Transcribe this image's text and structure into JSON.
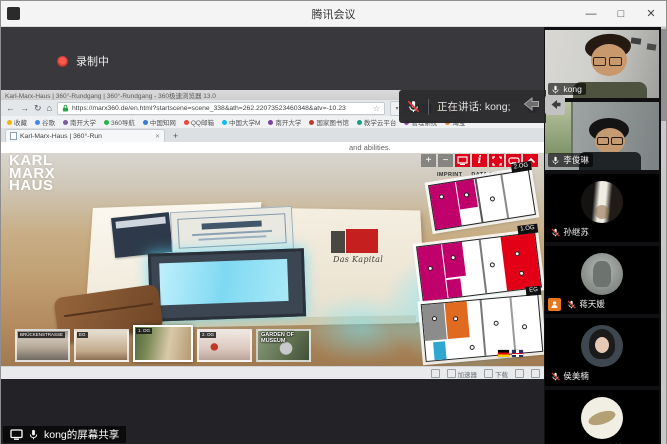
{
  "window": {
    "title": "腾讯会议",
    "minimize": "—",
    "maximize": "□",
    "close": "✕"
  },
  "meeting": {
    "recording_label": "录制中",
    "speaking_label": "正在讲话: kong;",
    "share_label": "kong的屏幕共享"
  },
  "participants": [
    {
      "name": "kong",
      "muted": false,
      "speaking": true
    },
    {
      "name": "李俊琳",
      "muted": false,
      "speaking": false
    },
    {
      "name": "孙继苏",
      "muted": true,
      "speaking": false
    },
    {
      "name": "蒋天媛",
      "muted": true,
      "speaking": false,
      "role_badge": true
    },
    {
      "name": "侯美楠",
      "muted": true,
      "speaking": false
    },
    {
      "name": "191820054张楠",
      "muted": true,
      "speaking": false
    }
  ],
  "browser": {
    "window_title": "Karl-Marx-Haus | 360°-Rundgang | 360°-Rundgang - 360极速浏览器 13.0",
    "url": "https://marx360.de/en.html?startscene=scene_338&ath=262.22073523460348&atv=-10.23",
    "star": "☆",
    "dropdown": "▾",
    "tab_title": "Karl-Marx-Haus | 360°-Run",
    "tab_close": "✕",
    "new_tab": "+",
    "nav": {
      "back": "←",
      "forward": "→",
      "refresh": "↻",
      "home": "⌂"
    },
    "bookmarks": [
      "收藏",
      "谷歌",
      "南开大学",
      "360导航",
      "中国知网",
      "QQ邮箱",
      "中国大学M",
      "南开大学",
      "国家图书馆",
      "教学云平台",
      "管理系统",
      "淘宝"
    ],
    "status_items": [
      "加速器",
      "下载"
    ]
  },
  "tour": {
    "logo_lines": [
      "KARL",
      "MARX",
      "HAUS"
    ],
    "top_text": "and abilities.",
    "zoom_in": "+",
    "zoom_out": "−",
    "info": "i",
    "links": {
      "imprint": "IMPRINT",
      "privacy": "DATA PROTECTION"
    },
    "book_title": "Das Kapital",
    "floors": [
      {
        "label": "2.OG"
      },
      {
        "label": "1.OG"
      },
      {
        "label": "EG"
      }
    ],
    "thumbnails": [
      {
        "label": "BRÜCKENSTRASSE",
        "selected": false
      },
      {
        "label": "EG",
        "selected": false
      },
      {
        "label": "1. OG",
        "selected": true
      },
      {
        "label": "2. OG",
        "selected": false
      },
      {
        "label": "GARDEN OF MUSEUM",
        "selected": false
      }
    ]
  },
  "colors": {
    "brand_red": "#dd0018",
    "magenta": "#c0006b",
    "orange": "#e06a1f",
    "blue": "#2fa7d0",
    "speaking_border": "#2aa54a",
    "record_red": "#d03a34",
    "role_badge_orange": "#e87722",
    "glow_cyan": "#6ee6ff"
  }
}
